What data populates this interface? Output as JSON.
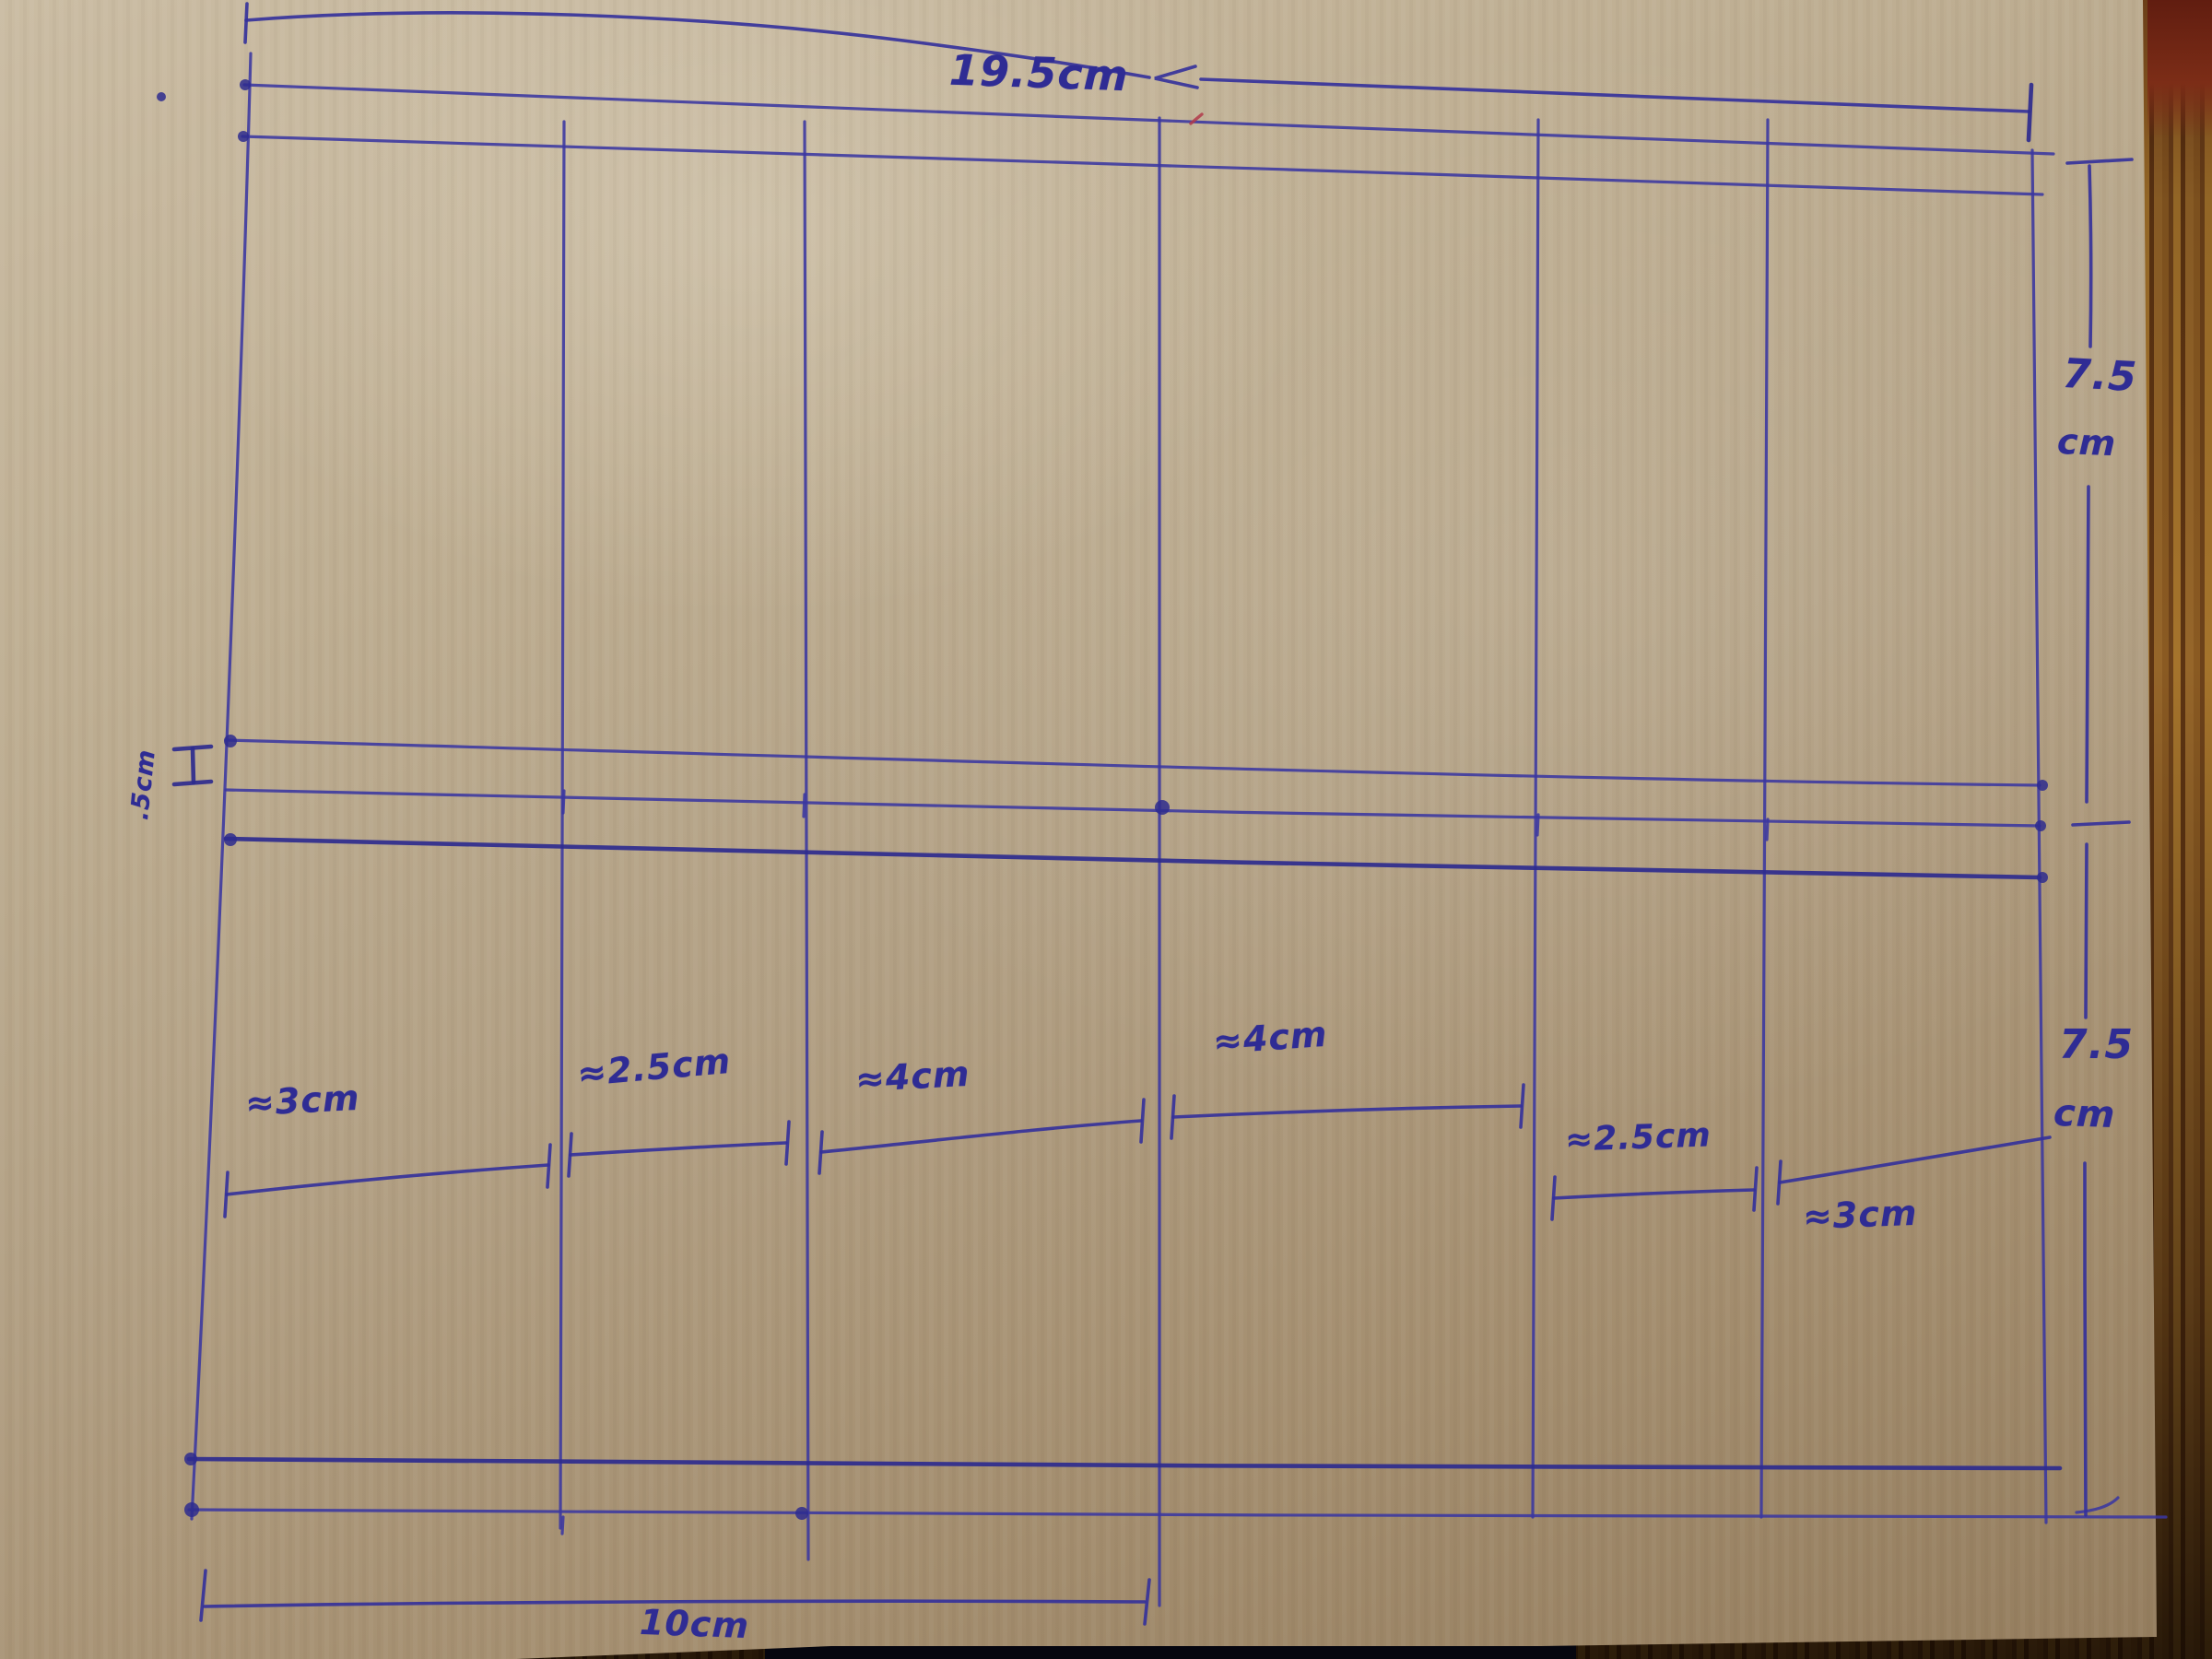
{
  "drawing": {
    "overall_width_label": "19.5cm",
    "upper_right_height": {
      "value": "7.5",
      "unit": "cm"
    },
    "lower_right_height": {
      "value": "7.5",
      "unit": "cm"
    },
    "middle_gap_label": ".5cm",
    "bottom_width_label": "10cm",
    "segment_labels": [
      "≈3cm",
      "≈2.5cm",
      "≈4cm",
      "≈4cm",
      "≈2.5cm",
      "≈3cm"
    ]
  },
  "colors": {
    "ink": "#33309b",
    "cardboard": "#b2a084",
    "wood": "#8a5a22",
    "red_mark": "#b23a4a"
  }
}
